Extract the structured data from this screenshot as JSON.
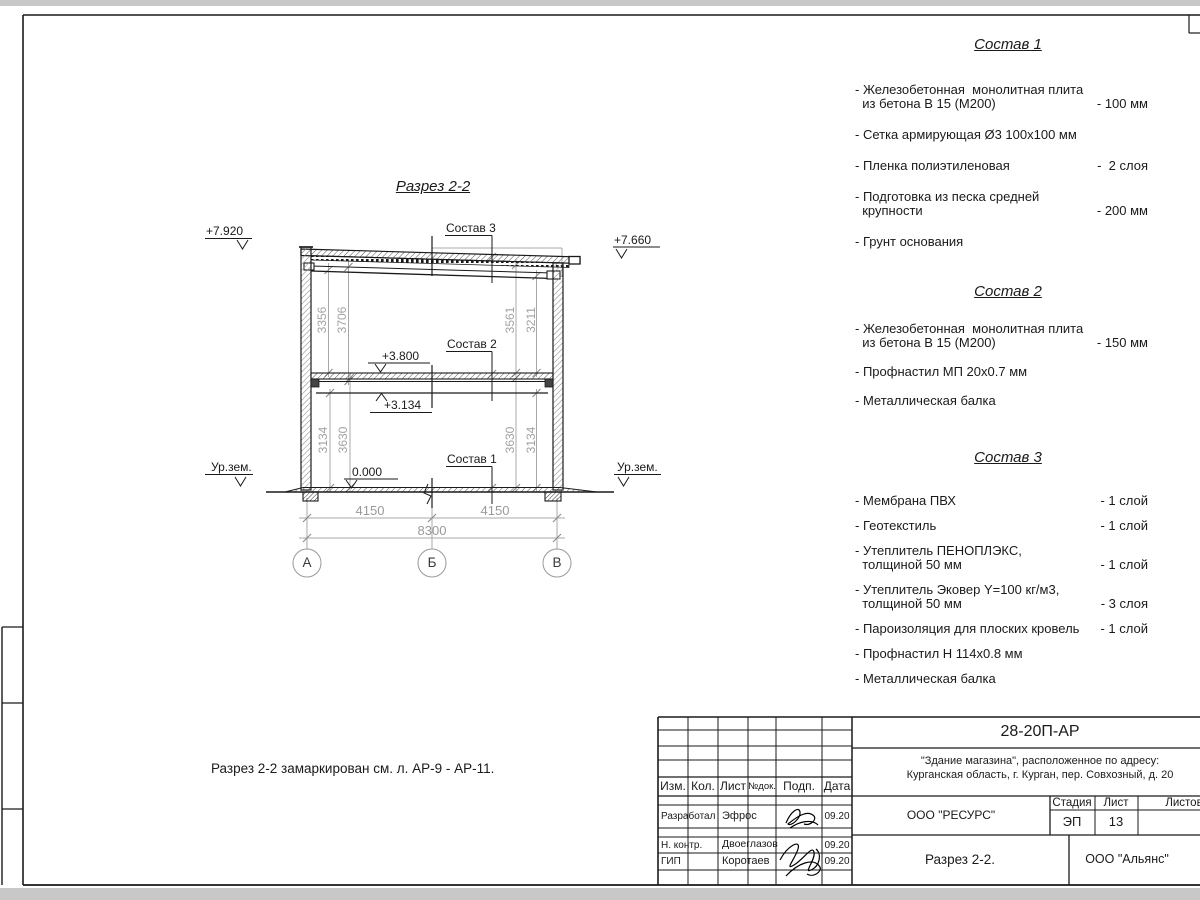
{
  "colors": {
    "line": "#1a1a1a",
    "dim_gray": "#9a9a9a"
  },
  "drawing": {
    "title": "Разрез 2-2",
    "note": "Разрез 2-2 замаркирован см. л. АР-9 - АР-11.",
    "elevations": {
      "roof_left": "+7.920",
      "roof_right": "+7.660",
      "floor2": "+3.800",
      "beam": "+3.134",
      "zero": "0.000"
    },
    "ground_label": "Ур.зем.",
    "composition_labels": {
      "c1": "Состав 1",
      "c2": "Состав 2",
      "c3": "Состав 3"
    },
    "vertical_dims": {
      "upper_left": [
        "3356",
        "3706"
      ],
      "upper_right": [
        "3561",
        "3211"
      ],
      "lower_left": [
        "3134",
        "3630"
      ],
      "lower_right": [
        "3630",
        "3134"
      ]
    },
    "horizontal_dims": {
      "span_left": "4150",
      "span_right": "4150",
      "total": "8300"
    },
    "axes": [
      "А",
      "Б",
      "В"
    ]
  },
  "compositions": [
    {
      "title": "Состав 1",
      "items": [
        {
          "name": "- Железобетонная  монолитная плита\n  из бетона В 15 (М200)",
          "value": "- 100 мм"
        },
        {
          "name": "- Сетка армирующая Ø3 100х100 мм",
          "value": ""
        },
        {
          "name": "- Пленка полиэтиленовая",
          "value": "-  2 слоя"
        },
        {
          "name": "- Подготовка из песка средней\n  крупности",
          "value": "- 200 мм"
        },
        {
          "name": "- Грунт основания",
          "value": ""
        }
      ]
    },
    {
      "title": "Состав 2",
      "items": [
        {
          "name": "- Железобетонная  монолитная плита\n  из бетона В 15 (М200)",
          "value": "- 150 мм"
        },
        {
          "name": "- Профнастил МП 20х0.7 мм",
          "value": ""
        },
        {
          "name": "- Металлическая балка",
          "value": ""
        }
      ]
    },
    {
      "title": "Состав 3",
      "items": [
        {
          "name": "- Мембрана ПВХ",
          "value": "- 1 слой"
        },
        {
          "name": "- Геотекстиль",
          "value": "- 1 слой"
        },
        {
          "name": "- Утеплитель ПЕНОПЛЭКС,\n  толщиной 50 мм",
          "value": "- 1 слой"
        },
        {
          "name": "- Утеплитель Эковер Y=100 кг/м3,\n  толщиной 50 мм",
          "value": "- 3 слоя"
        },
        {
          "name": "- Пароизоляция для плоских кровель",
          "value": "- 1 слой"
        },
        {
          "name": "- Профнастил Н 114х0.8 мм",
          "value": ""
        },
        {
          "name": "- Металлическая балка",
          "value": ""
        }
      ]
    }
  ],
  "title_block": {
    "doc_number": "28-20П-АР",
    "project_line1": "\"Здание магазина\", расположенное по адресу:",
    "project_line2": "Курганская область, г. Курган, пер. Совхозный, д. 20",
    "columns": {
      "izm": "Изм.",
      "kol": "Кол.",
      "list": "Лист",
      "ndok": "№док.",
      "podp": "Подп.",
      "data": "Дата"
    },
    "rows": [
      {
        "role": "Разработал",
        "name": "Эфрос",
        "date": "09.20"
      },
      {
        "role": "Н. контр.",
        "name": "Двоеглазов",
        "date": "09.20"
      },
      {
        "role": "ГИП",
        "name": "Коротаев",
        "date": "09.20"
      }
    ],
    "org": "ООО \"РЕСУРС\"",
    "stage_label": "Стадия",
    "sheet_label": "Лист",
    "sheets_label": "Листов",
    "stage": "ЭП",
    "sheet": "13",
    "sheet_title": "Разрез 2-2.",
    "contractor": "ООО \"Альянс\""
  }
}
